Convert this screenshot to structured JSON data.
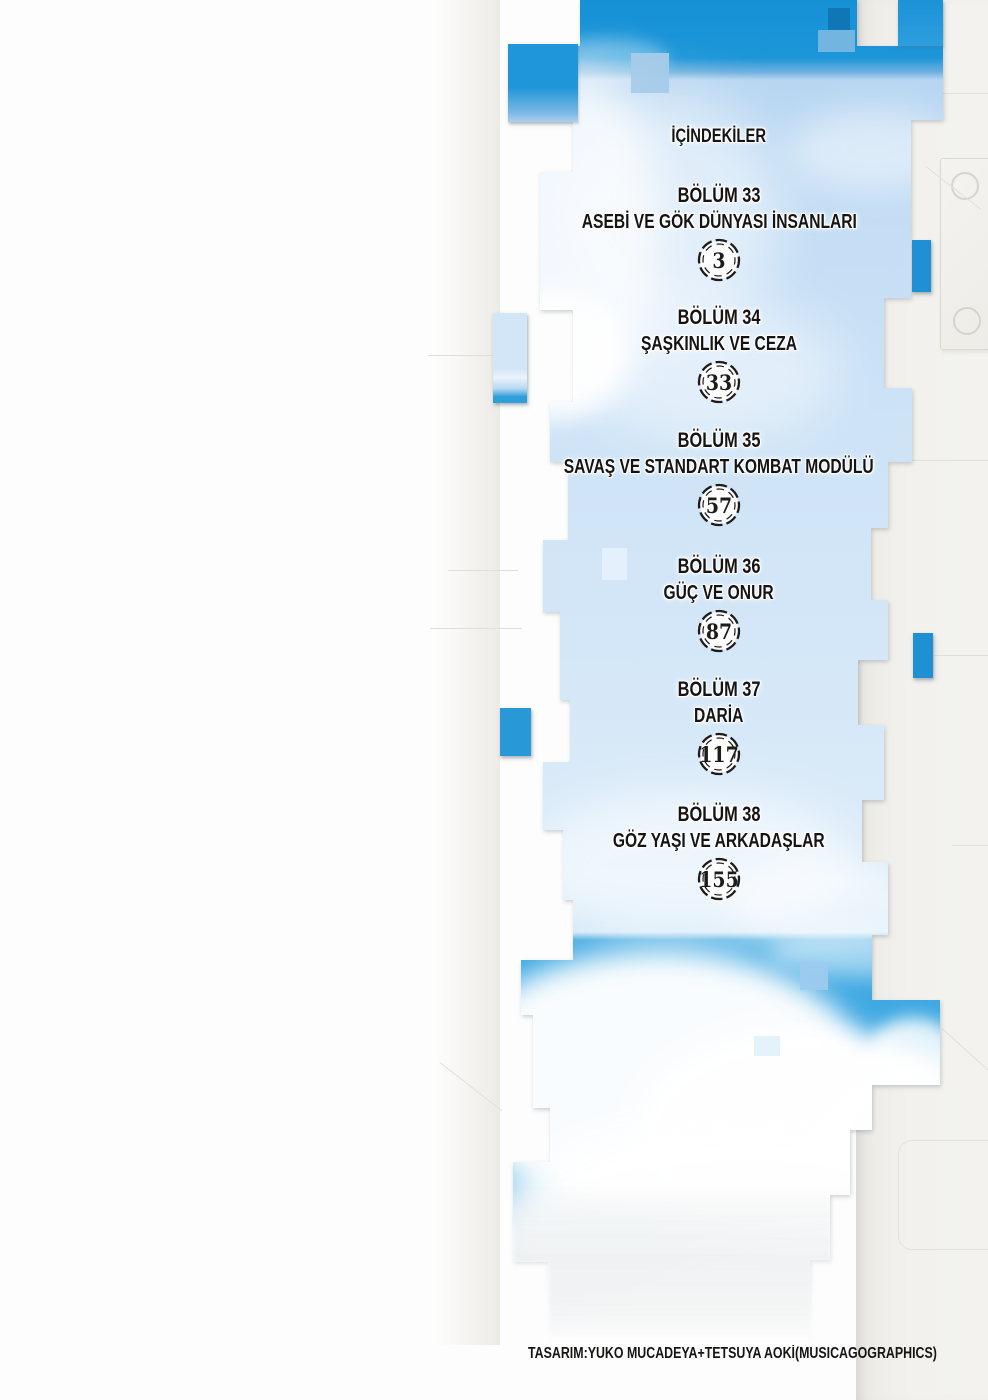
{
  "page": {
    "title": "İÇİNDEKİLER",
    "credit": "TASARIM:YUKO MUCADEYA+TETSUYA AOKİ(MUSICAGOGRAPHICS)"
  },
  "chapters": [
    {
      "chapter": "BÖLÜM 33",
      "title": "ASEBİ VE GÖK DÜNYASI İNSANLARI",
      "page": "3"
    },
    {
      "chapter": "BÖLÜM 34",
      "title": "ŞAŞKINLIK VE CEZA",
      "page": "33"
    },
    {
      "chapter": "BÖLÜM 35",
      "title": "SAVAŞ VE STANDART KOMBAT MODÜLÜ",
      "page": "57"
    },
    {
      "chapter": "BÖLÜM 36",
      "title": "GÜÇ VE ONUR",
      "page": "87"
    },
    {
      "chapter": "BÖLÜM 37",
      "title": "DARİA",
      "page": "117"
    },
    {
      "chapter": "BÖLÜM 38",
      "title": "GÖZ YAŞI VE ARKADAŞLAR",
      "page": "155"
    }
  ],
  "colors": {
    "sky_vivid": "#1e96d9",
    "sky_light": "#c9e0f5",
    "sky_bottom": "#45abe3",
    "text": "#151413",
    "paper": "#f1f0ec"
  }
}
